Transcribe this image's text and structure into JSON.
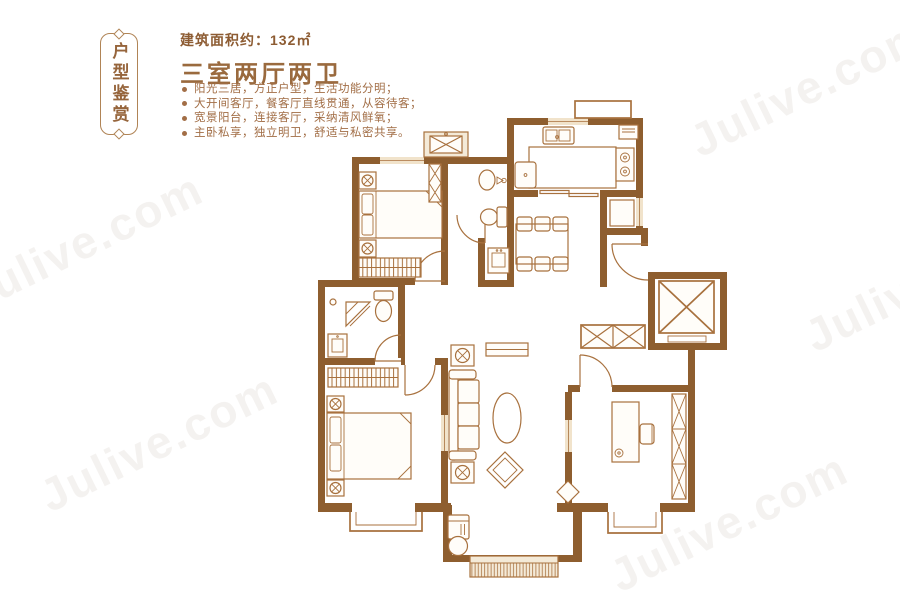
{
  "watermark": {
    "text": "Julive.com"
  },
  "banner": {
    "text": "户型鉴赏"
  },
  "header": {
    "area_label": "建筑面积约：132㎡",
    "title": "三室两厅两卫"
  },
  "features": [
    "阳光三居，方正户型，生活功能分明；",
    "大开间客厅，餐客厅直线贯通，从容待客；",
    "宽景阳台，连接客厅，采纳清风鲜氧；",
    "主卧私享，独立明卫，舒适与私密共享。"
  ],
  "colors": {
    "wall": "#8e5e2f",
    "furn": "#a8713e",
    "beige": "#f1e3cb",
    "hatch": "#f4ead8",
    "furnfill": "#fffdf9",
    "text_dark": "#9a6a3e",
    "text_mid": "#8d5c33",
    "text_body": "#a26e46",
    "banner": "#96653c",
    "banner_border": "#b08456",
    "watermark": "rgba(175,162,150,0.14)"
  }
}
